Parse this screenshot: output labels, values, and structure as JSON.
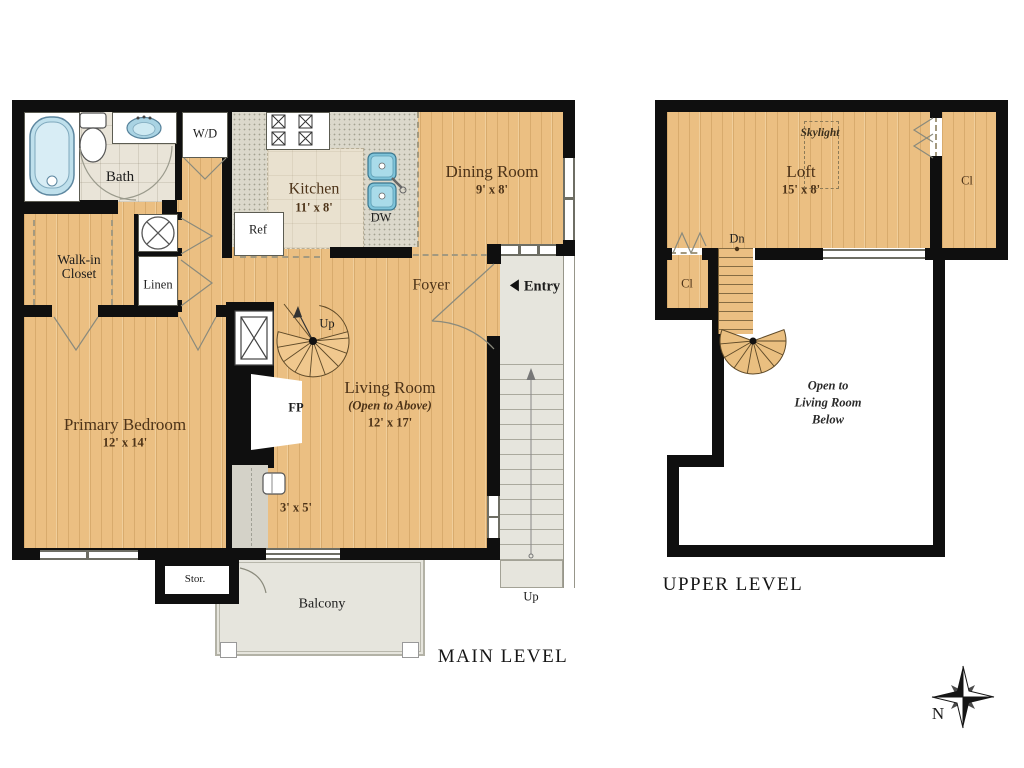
{
  "colors": {
    "wall": "#0f0f0f",
    "wood_floor": "#ebbf82",
    "outdoor_gray": "#e6e5dd",
    "bath_tile": "#e9e4d8",
    "counter_speckle": "#dbd8cb",
    "fixture_blue": "#a9d3e3",
    "room_label_brown": "#4d3318"
  },
  "main": {
    "title": "MAIN LEVEL",
    "bath": {
      "label": "Bath"
    },
    "wd": {
      "label": "W/D"
    },
    "kitchen": {
      "name": "Kitchen",
      "dims": "11' x 8'"
    },
    "ref": {
      "label": "Ref"
    },
    "dw": {
      "label": "DW"
    },
    "dining": {
      "name": "Dining Room",
      "dims": "9' x 8'"
    },
    "walk_in": {
      "label": "Walk-in Closet"
    },
    "linen": {
      "label": "Linen"
    },
    "foyer": {
      "label": "Foyer"
    },
    "entry": {
      "label": "Entry"
    },
    "living": {
      "name": "Living Room",
      "sub": "(Open to Above)",
      "dims": "12' x 17'"
    },
    "primary": {
      "name": "Primary Bedroom",
      "dims": "12' x 14'"
    },
    "fireplace": {
      "label": "FP"
    },
    "nook": {
      "dims": "3' x 5'"
    },
    "spiral": {
      "label": "Up"
    },
    "storage": {
      "label": "Stor."
    },
    "balcony": {
      "label": "Balcony"
    },
    "entry_stairs": {
      "label": "Up"
    }
  },
  "upper": {
    "title": "UPPER LEVEL",
    "loft": {
      "name": "Loft",
      "dims": "15' x 8'"
    },
    "skylight": {
      "label": "Skylight"
    },
    "closet_right": {
      "label": "Cl"
    },
    "closet_left": {
      "label": "Cl"
    },
    "stairs_down": {
      "label": "Dn"
    },
    "open_below": {
      "line1": "Open to",
      "line2": "Living Room",
      "line3": "Below"
    }
  },
  "compass": {
    "north": "N"
  }
}
